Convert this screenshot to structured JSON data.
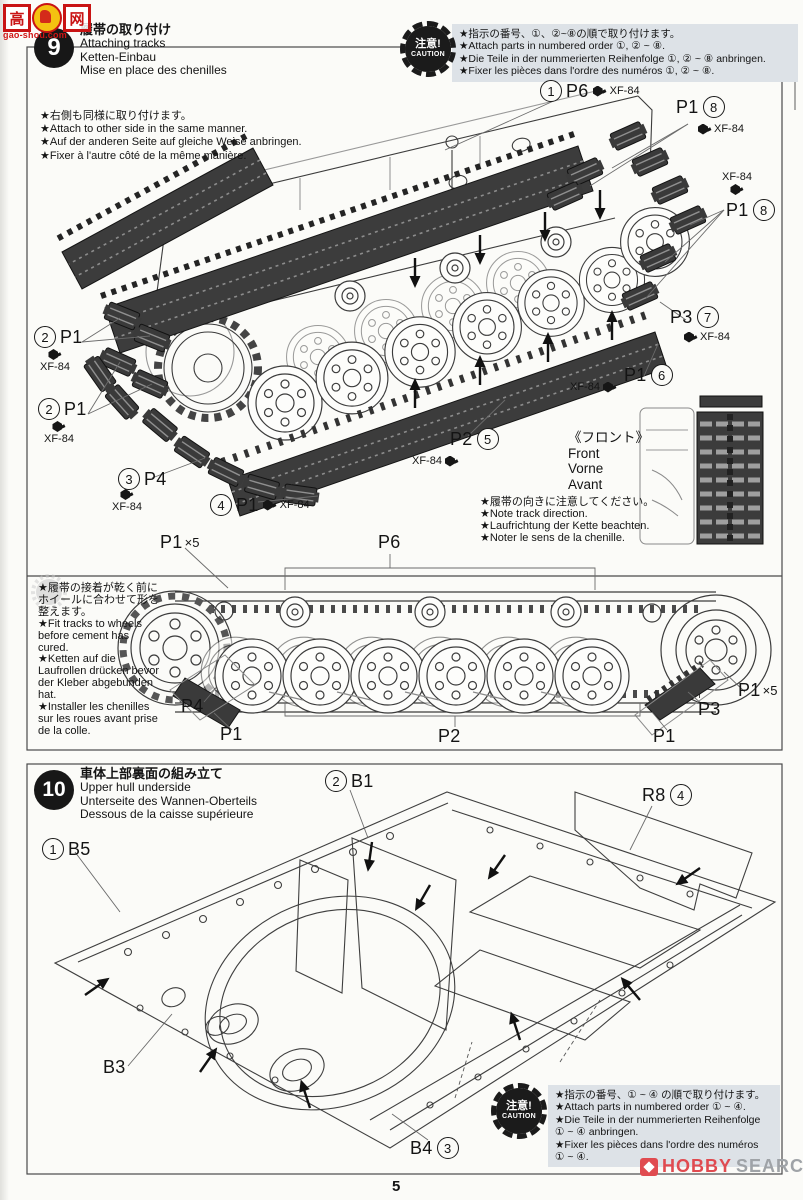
{
  "watermark_top": {
    "char1": "高",
    "char2": "网",
    "url": "gao-shou.com"
  },
  "watermark_bottom": {
    "part1": "HOBBY",
    "part2": "SEARCH"
  },
  "page_number": "5",
  "step9": {
    "badge": "9",
    "title": {
      "ja": "履帯の取り付け",
      "en": "Attaching tracks",
      "de": "Ketten-Einbau",
      "fr": "Mise en place des chenilles"
    },
    "caution": {
      "badge_line1": "注意!",
      "badge_line2": "CAUTION",
      "lines": [
        "★指示の番号、①、②~⑧の順で取り付けます。",
        "★Attach parts in numbered order ①, ② ~ ⑧.",
        "★Die Teile in der nummerierten Reihenfolge ①, ② ~ ⑧ anbringen.",
        "★Fixer les pièces dans l'ordre des numéros ①, ② ~ ⑧."
      ]
    },
    "note_attach": {
      "lines": [
        "★右側も同様に取り付けます。",
        "★Attach to other side in the same manner.",
        "★Auf der anderen Seite auf gleiche Weise anbringen.",
        "★Fixer à l'autre côté de la même manière."
      ]
    },
    "front": {
      "ja": "《フロント》",
      "en": "Front",
      "de": "Vorne",
      "fr": "Avant"
    },
    "note_direction": {
      "lines": [
        "★履帯の向きに注意してください。",
        "★Note track direction.",
        "★Laufrichtung der Kette beachten.",
        "★Noter le sens de la chenille."
      ]
    },
    "labels": {
      "p6_1": {
        "num": "1",
        "part": "P6",
        "paint": "XF-84"
      },
      "p1_8a": {
        "part": "P1",
        "num": "8",
        "paint": "XF-84"
      },
      "p1_8b": {
        "part": "P1",
        "num": "8",
        "paint": "XF-84"
      },
      "p3_7": {
        "part": "P3",
        "num": "7",
        "paint": "XF-84"
      },
      "p1_6": {
        "part": "P1",
        "num": "6",
        "paint": "XF-84"
      },
      "p2_5": {
        "part": "P2",
        "num": "5",
        "paint": "XF-84"
      },
      "p1_2a": {
        "num": "2",
        "part": "P1",
        "paint": "XF-84"
      },
      "p1_2b": {
        "num": "2",
        "part": "P1",
        "paint": "XF-84"
      },
      "p4_3": {
        "num": "3",
        "part": "P4",
        "paint": "XF-84"
      },
      "p1_4": {
        "num": "4",
        "part": "P1",
        "paint": "XF-84"
      },
      "p1x5_top": {
        "part": "P1",
        "mult": "×5"
      },
      "p6_top": {
        "part": "P6"
      }
    }
  },
  "side_panel": {
    "note_fit": {
      "lines": [
        "★履帯の接着が乾く前に",
        "ホイールに合わせて形を",
        "整えます。",
        "★Fit tracks to wheels",
        "before cement has",
        "cured.",
        "★Ketten auf die",
        "Laufrollen drücken bevor",
        "der Kleber abgebunden",
        "hat.",
        "★Installer les chenilles",
        "sur les roues avant prise",
        "de la colle."
      ]
    },
    "labels": {
      "p4": "P4",
      "p1_left": "P1",
      "p2": "P2",
      "p1_right": "P1",
      "p3": "P3",
      "p1x5_right_part": "P1",
      "p1x5_right_mult": "×5"
    }
  },
  "step10": {
    "badge": "10",
    "title": {
      "ja": "車体上部裏面の組み立て",
      "en": "Upper hull underside",
      "de": "Unterseite des Wannen-Oberteils",
      "fr": "Dessous de la caisse supérieure"
    },
    "labels": {
      "b1": {
        "num": "2",
        "part": "B1"
      },
      "b5": {
        "num": "1",
        "part": "B5"
      },
      "r8": {
        "part": "R8",
        "num": "4"
      },
      "b3": {
        "part": "B3"
      },
      "b4": {
        "part": "B4",
        "num": "3"
      }
    },
    "caution": {
      "badge_line1": "注意!",
      "badge_line2": "CAUTION",
      "lines": [
        "★指示の番号、① ~ ④ の順で取り付けます。",
        "★Attach parts in numbered order ① ~ ④.",
        "★Die Teile in der nummerierten Reihenfolge",
        "① ~ ④ anbringen.",
        "★Fixer les pièces dans l'ordre des numéros",
        "① ~ ④."
      ]
    }
  }
}
